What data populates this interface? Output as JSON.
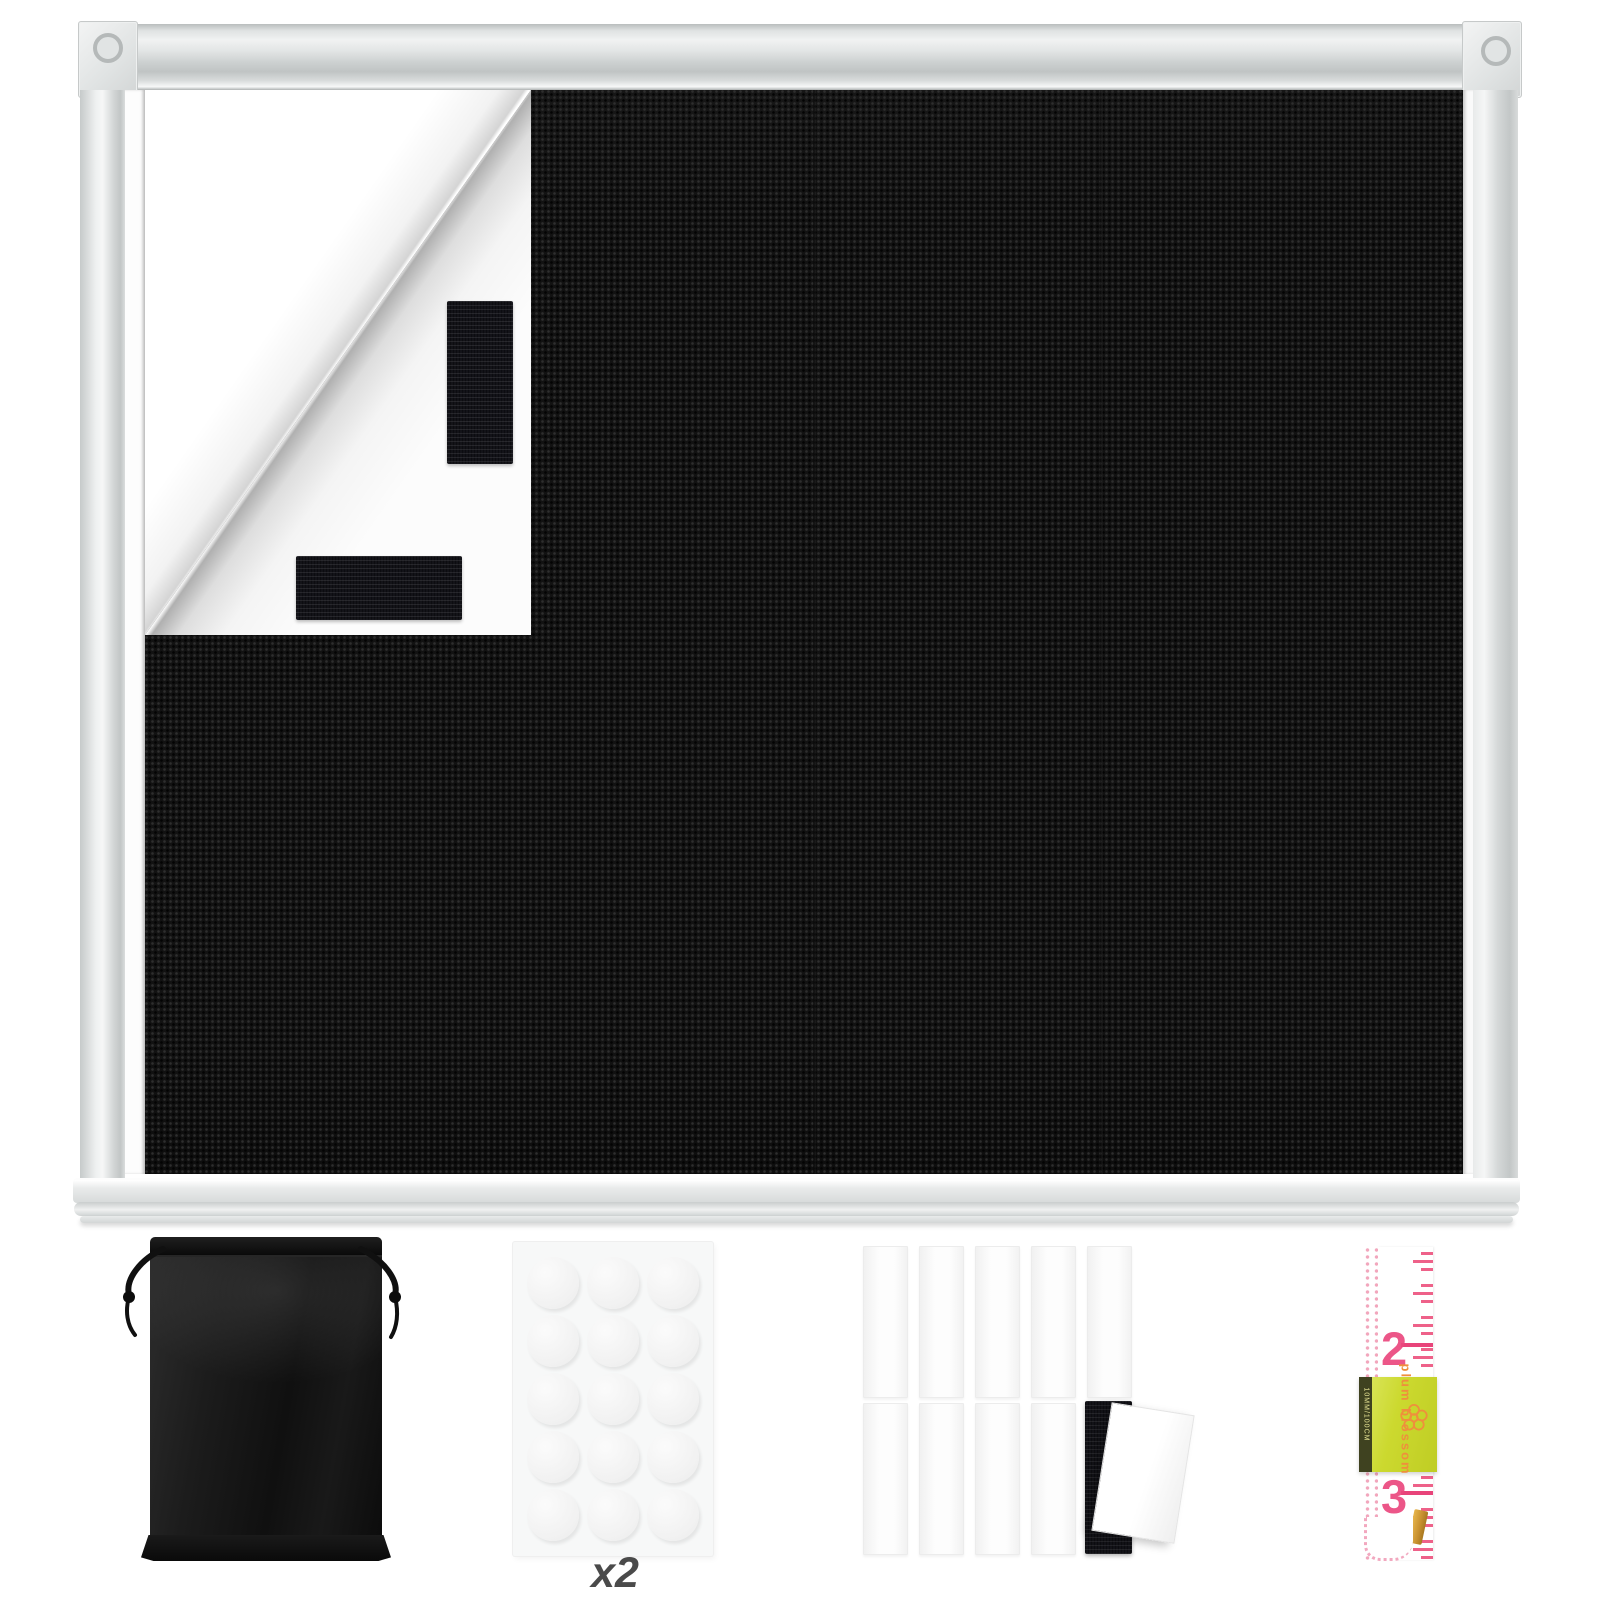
{
  "window": {
    "frame_color": "#e4e6e6",
    "fabric_color": "#121212",
    "backing_color": "#fcfcfc",
    "velcro_patch_color": "#131318",
    "velcro_patch_count": 2
  },
  "accessories": {
    "storage_bag": {
      "color": "#1a1a1a"
    },
    "adhesive_dots": {
      "rows": 5,
      "columns": 3,
      "count": 15,
      "multiplier_label": "x2",
      "dot_color": "#f1f1f1"
    },
    "hook_loop_strips": {
      "rows": 2,
      "columns": 5,
      "white_strip_count": 10,
      "black_strip_count": 1,
      "strip_color": "#fdfdfd",
      "black_strip_color": "#131318"
    },
    "measuring_tape": {
      "numbers": [
        "2",
        "3"
      ],
      "marking_color": "#ee5e86",
      "band": {
        "brand": "plum blossom",
        "side_label": "10MM/100CM",
        "color": "#ccd92f",
        "text_color": "#ef8f3c"
      },
      "clip_color": "#d3a23f"
    }
  }
}
